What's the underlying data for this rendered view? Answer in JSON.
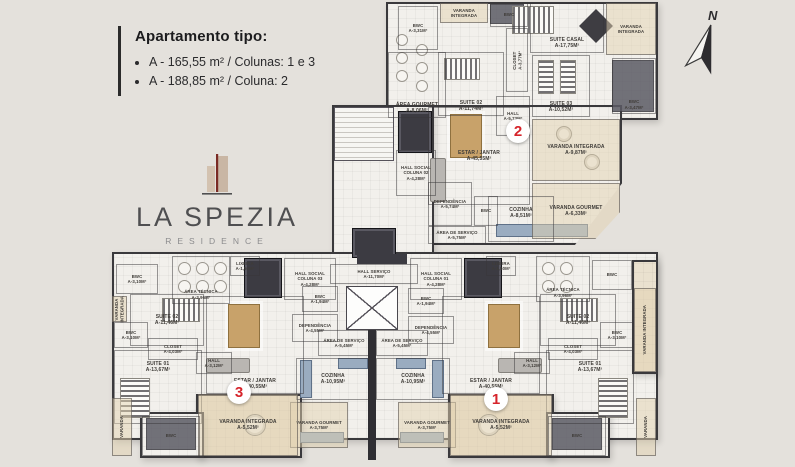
{
  "header": {
    "title": "Apartamento tipo:",
    "items": [
      "A - 165,55 m² / Colunas: 1 e 3",
      "A - 188,85 m² / Coluna: 2"
    ]
  },
  "logo": {
    "title": "LA SPEZIA",
    "subtitle": "RESIDENCE"
  },
  "compass": {
    "label": "N"
  },
  "colors": {
    "background": "#e4e1dc",
    "wall": "#3a393c",
    "floor": "#f2f0ec",
    "balcony": "#eae1cf",
    "wood": "#c8a26a",
    "counter": "#9aacc0",
    "red": "#d6242b",
    "dark": "#45454c",
    "logo_text": "#4f4f51",
    "logo_sub": "#8c8c8e",
    "logo_beige": "#d3c2b0",
    "logo_red": "#7a2a24"
  },
  "floorplan": {
    "unit_markers": [
      {
        "number": "2",
        "x": 518,
        "y": 131
      },
      {
        "number": "3",
        "x": 239,
        "y": 392
      },
      {
        "number": "1",
        "x": 496,
        "y": 399
      }
    ],
    "rooms": [
      {
        "label": "BWC",
        "area": "A-3,31m²",
        "x": 398,
        "y": 6,
        "w": 40,
        "h": 44,
        "sm": true
      },
      {
        "label": "ÁREA GOURMET",
        "area": "A-8,06m²",
        "x": 388,
        "y": 52,
        "w": 58,
        "h": 66,
        "la": "b"
      },
      {
        "label": "VARANDA INTEGRADA",
        "area": "",
        "x": 440,
        "y": 3,
        "w": 48,
        "h": 20,
        "style": "balcony",
        "sm": true
      },
      {
        "label": "BWC",
        "area": "",
        "x": 490,
        "y": 3,
        "w": 38,
        "h": 24,
        "sm": true
      },
      {
        "label": "SUITE 02",
        "area": "A-11,74m²",
        "x": 438,
        "y": 52,
        "w": 66,
        "h": 64,
        "la": "b"
      },
      {
        "label": "CLOSET",
        "area": "A-3,77m²",
        "x": 506,
        "y": 28,
        "w": 22,
        "h": 64,
        "vertical": true,
        "sm": true
      },
      {
        "label": "SUITE CASAL",
        "area": "A-17,75m²",
        "x": 530,
        "y": 3,
        "w": 74,
        "h": 50,
        "la": "b"
      },
      {
        "label": "VARANDA INTEGRADA",
        "area": "",
        "x": 606,
        "y": 3,
        "w": 50,
        "h": 52,
        "style": "balcony",
        "sm": true
      },
      {
        "label": "SUITE 03",
        "area": "A-10,52m²",
        "x": 532,
        "y": 55,
        "w": 58,
        "h": 62,
        "la": "b"
      },
      {
        "label": "BWC",
        "area": "A-3,47m²",
        "x": 612,
        "y": 58,
        "w": 44,
        "h": 56,
        "la": "b",
        "sm": true
      },
      {
        "label": "HALL",
        "area": "A-5,73m²",
        "x": 496,
        "y": 96,
        "w": 34,
        "h": 40,
        "sm": true
      },
      {
        "label": "ESTAR / JANTAR",
        "area": "A-45,55m²",
        "x": 428,
        "y": 107,
        "w": 102,
        "h": 98
      },
      {
        "label": "VARANDA INTEGRADA",
        "area": "A-9,87m²",
        "x": 532,
        "y": 119,
        "w": 88,
        "h": 62,
        "style": "balcony"
      },
      {
        "label": "VARANDA GOURMET",
        "area": "A-6,33m²",
        "x": 532,
        "y": 183,
        "w": 88,
        "h": 56,
        "style": "balcony",
        "cut": true
      },
      {
        "label": "COZINHA",
        "area": "A-8,51m²",
        "x": 488,
        "y": 196,
        "w": 66,
        "h": 46,
        "la": "t"
      },
      {
        "label": "DEPENDÊNCIA",
        "area": "A-5,74m²",
        "x": 428,
        "y": 182,
        "w": 44,
        "h": 44,
        "sm": true
      },
      {
        "label": "BWC",
        "area": "",
        "x": 474,
        "y": 196,
        "w": 24,
        "h": 30,
        "sm": true
      },
      {
        "label": "ÁREA DE SERVIÇO",
        "area": "A-5,75m²",
        "x": 428,
        "y": 226,
        "w": 58,
        "h": 18,
        "sm": true
      },
      {
        "label": "HALL SOCIAL COLUNA 02",
        "area": "A-4,28m²",
        "x": 396,
        "y": 150,
        "w": 40,
        "h": 46,
        "sm": true
      },
      {
        "label": "HALL SERVIÇO",
        "area": "A-11,70m²",
        "x": 330,
        "y": 264,
        "w": 88,
        "h": 20,
        "sm": true
      },
      {
        "label": "BWC",
        "area": "A-3,10m²",
        "x": 116,
        "y": 264,
        "w": 42,
        "h": 30,
        "sm": true
      },
      {
        "label": "ÁREA TÉCNICA",
        "area": "A-3,96m²",
        "x": 172,
        "y": 256,
        "w": 58,
        "h": 48,
        "sm": true,
        "la": "b"
      },
      {
        "label": "LIXEIRA",
        "area": "A-1,50m²",
        "x": 230,
        "y": 256,
        "w": 30,
        "h": 20,
        "sm": true
      },
      {
        "label": "HALL SOCIAL COLUNA 03",
        "area": "A-4,28m²",
        "x": 284,
        "y": 258,
        "w": 52,
        "h": 42,
        "sm": true
      },
      {
        "label": "BWC",
        "area": "A-1,94m²",
        "x": 302,
        "y": 286,
        "w": 36,
        "h": 26,
        "sm": true
      },
      {
        "label": "DEPENDÊNCIA",
        "area": "A-4,55m²",
        "x": 292,
        "y": 314,
        "w": 46,
        "h": 28,
        "sm": true
      },
      {
        "label": "ÁREA DE SERVIÇO",
        "area": "A-5,45m²",
        "x": 318,
        "y": 330,
        "w": 52,
        "h": 26,
        "sm": true
      },
      {
        "label": "COZINHA",
        "area": "A-10,95m²",
        "x": 296,
        "y": 358,
        "w": 74,
        "h": 42
      },
      {
        "label": "VARANDA GOURMET",
        "area": "A-3,75m²",
        "x": 290,
        "y": 402,
        "w": 58,
        "h": 46,
        "style": "balcony",
        "sm": true
      },
      {
        "label": "ESTAR / JANTAR",
        "area": "A-40,55m²",
        "x": 206,
        "y": 296,
        "w": 98,
        "h": 98,
        "la": "b"
      },
      {
        "label": "SUITE 02",
        "area": "A-11,46m²",
        "x": 130,
        "y": 294,
        "w": 74,
        "h": 52
      },
      {
        "label": "VARANDA INTEGRADA",
        "area": "",
        "x": 112,
        "y": 296,
        "w": 15,
        "h": 26,
        "vertical": true,
        "style": "balcony",
        "sm": true
      },
      {
        "label": "BWC",
        "area": "A-3,10m²",
        "x": 114,
        "y": 322,
        "w": 34,
        "h": 26,
        "sm": true
      },
      {
        "label": "CLOSET",
        "area": "A-4,03m²",
        "x": 148,
        "y": 338,
        "w": 50,
        "h": 22,
        "sm": true
      },
      {
        "label": "SUITE 01",
        "area": "A-13,67m²",
        "x": 114,
        "y": 350,
        "w": 88,
        "h": 74,
        "la": "t"
      },
      {
        "label": "HALL",
        "area": "A-3,12m²",
        "x": 196,
        "y": 352,
        "w": 36,
        "h": 22,
        "sm": true
      },
      {
        "label": "VARANDA INTEGRADA",
        "area": "A-5,52m²",
        "x": 198,
        "y": 394,
        "w": 100,
        "h": 62,
        "style": "balcony"
      },
      {
        "label": "BWC",
        "area": "",
        "x": 142,
        "y": 416,
        "w": 58,
        "h": 40,
        "sm": true
      },
      {
        "label": "VARANDA",
        "area": "",
        "x": 112,
        "y": 398,
        "w": 20,
        "h": 58,
        "vertical": true,
        "style": "balcony",
        "sm": true
      },
      {
        "label": "ÁREA TÉCNICA",
        "area": "A-3,96m²",
        "x": 536,
        "y": 256,
        "w": 54,
        "h": 46,
        "sm": true,
        "la": "b"
      },
      {
        "label": "BWC",
        "area": "",
        "x": 592,
        "y": 260,
        "w": 40,
        "h": 30,
        "sm": true
      },
      {
        "label": "LIXEIRA",
        "area": "A-1,50m²",
        "x": 486,
        "y": 256,
        "w": 30,
        "h": 20,
        "sm": true
      },
      {
        "label": "HALL SOCIAL COLUNA 01",
        "area": "A-4,28m²",
        "x": 410,
        "y": 258,
        "w": 52,
        "h": 42,
        "sm": true
      },
      {
        "label": "BWC",
        "area": "A-1,94m²",
        "x": 408,
        "y": 288,
        "w": 36,
        "h": 26,
        "sm": true
      },
      {
        "label": "DEPENDÊNCIA",
        "area": "A-4,55m²",
        "x": 408,
        "y": 316,
        "w": 46,
        "h": 28,
        "sm": true
      },
      {
        "label": "ÁREA DE SERVIÇO",
        "area": "A-5,45m²",
        "x": 376,
        "y": 330,
        "w": 52,
        "h": 26,
        "sm": true
      },
      {
        "label": "COZINHA",
        "area": "A-10,95m²",
        "x": 376,
        "y": 358,
        "w": 74,
        "h": 42
      },
      {
        "label": "VARANDA GOURMET",
        "area": "A-3,75m²",
        "x": 398,
        "y": 402,
        "w": 58,
        "h": 46,
        "style": "balcony",
        "sm": true
      },
      {
        "label": "ESTAR / JANTAR",
        "area": "A-40,55m²",
        "x": 442,
        "y": 296,
        "w": 98,
        "h": 98,
        "la": "b"
      },
      {
        "label": "SUITE 02",
        "area": "A-11,46m²",
        "x": 540,
        "y": 294,
        "w": 76,
        "h": 52
      },
      {
        "label": "BWC",
        "area": "A-3,10m²",
        "x": 600,
        "y": 322,
        "w": 34,
        "h": 26,
        "sm": true
      },
      {
        "label": "VARANDA INTEGRADA",
        "area": "",
        "x": 634,
        "y": 288,
        "w": 22,
        "h": 84,
        "vertical": true,
        "style": "balcony",
        "sm": true
      },
      {
        "label": "CLOSET",
        "area": "A-4,03m²",
        "x": 548,
        "y": 338,
        "w": 50,
        "h": 22,
        "sm": true
      },
      {
        "label": "HALL",
        "area": "A-3,12m²",
        "x": 514,
        "y": 352,
        "w": 36,
        "h": 22,
        "sm": true
      },
      {
        "label": "SUITE 01",
        "area": "A-13,67m²",
        "x": 546,
        "y": 350,
        "w": 88,
        "h": 74,
        "la": "t"
      },
      {
        "label": "VARANDA INTEGRADA",
        "area": "A-5,52m²",
        "x": 450,
        "y": 394,
        "w": 102,
        "h": 62,
        "style": "balcony"
      },
      {
        "label": "BWC",
        "area": "",
        "x": 548,
        "y": 416,
        "w": 58,
        "h": 40,
        "sm": true
      },
      {
        "label": "VARANDA",
        "area": "",
        "x": 636,
        "y": 398,
        "w": 20,
        "h": 58,
        "vertical": true,
        "style": "balcony",
        "sm": true
      }
    ]
  }
}
